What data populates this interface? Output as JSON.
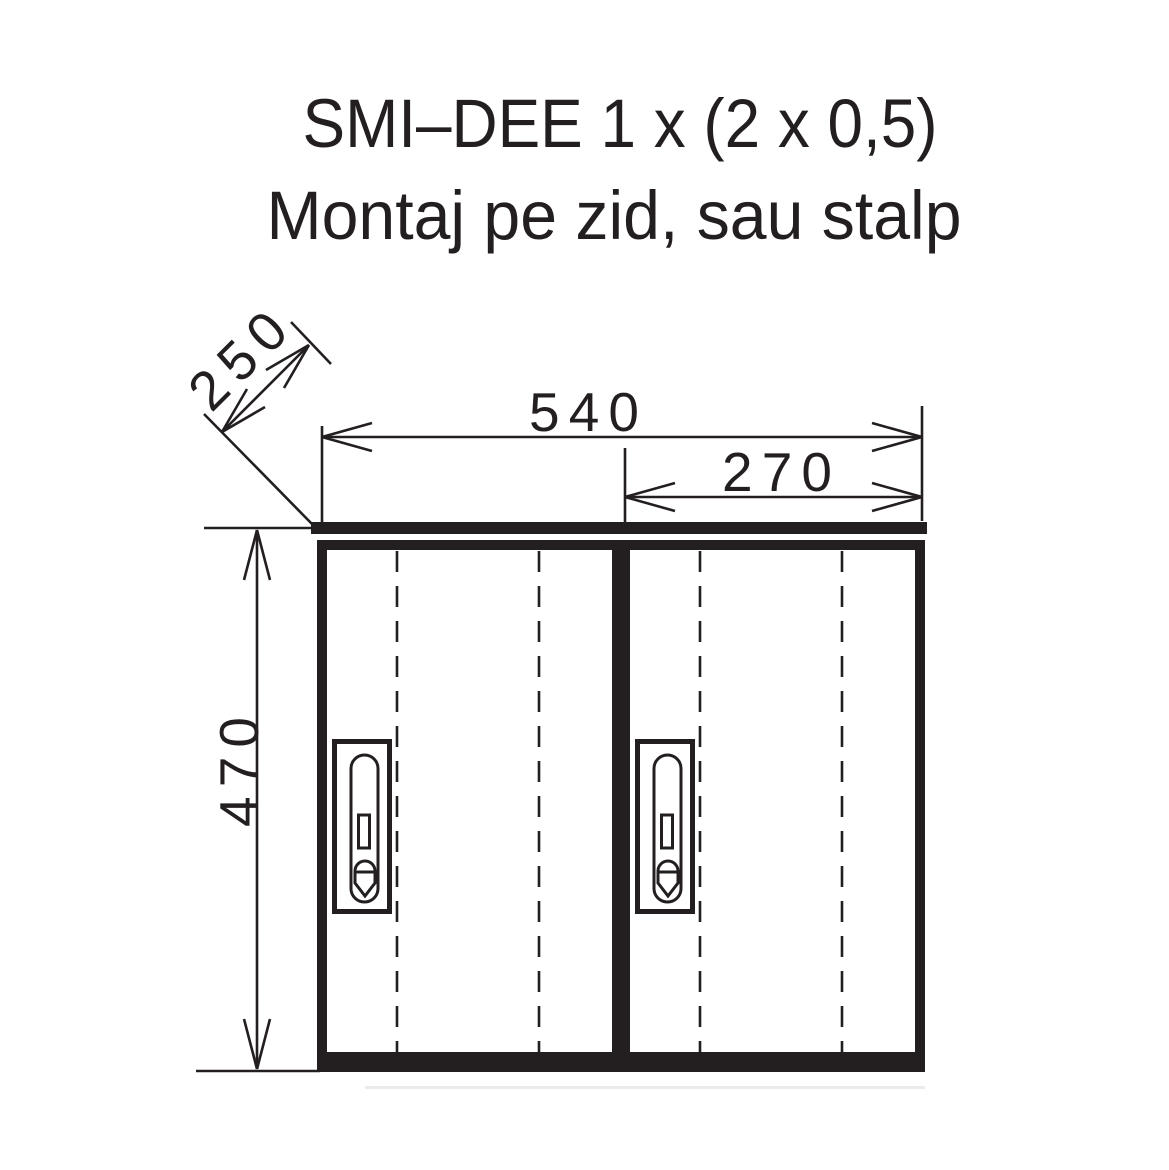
{
  "title": {
    "line1": "SMI–DEE 1 x (2 x 0,5)",
    "line2": "Montaj pe zid, sau stalp"
  },
  "dimensions_mm": {
    "depth": "250",
    "overall_width": "540",
    "door_width": "270",
    "height": "470"
  },
  "colors": {
    "ink": "#231f20",
    "background": "#ffffff",
    "shadow": "#ebebeb"
  }
}
